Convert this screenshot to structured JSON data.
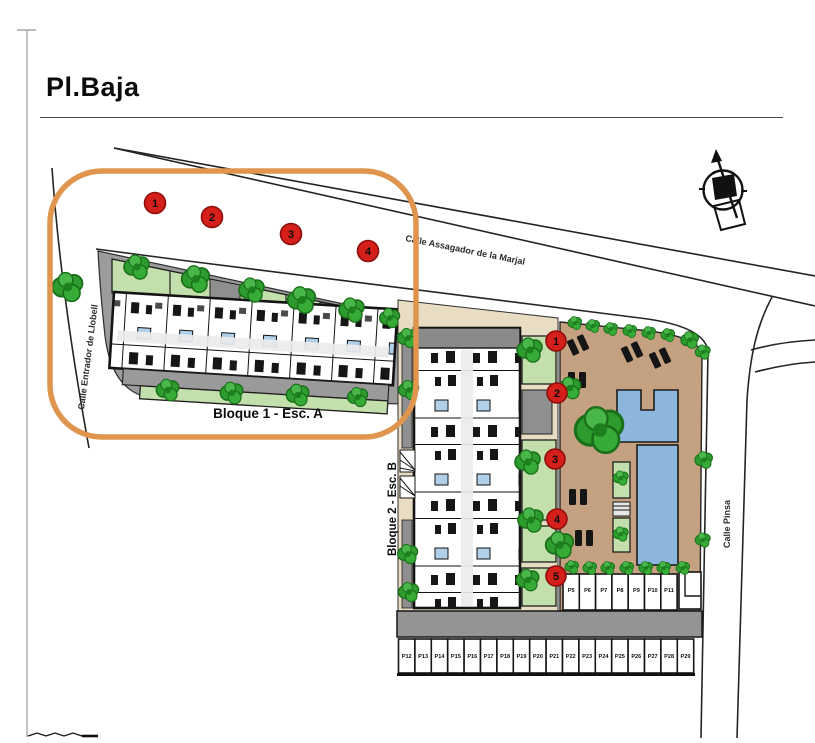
{
  "title": "Pl.Baja",
  "streets": {
    "top": "Calle Assagador de la Marjal",
    "left": "Calle Entrador de Llobell",
    "right": "Calle Pinsa"
  },
  "block1": {
    "label": "Bloque 1 - Esc. A",
    "markers": [
      "1",
      "2",
      "3",
      "4"
    ]
  },
  "block2": {
    "label": "Bloque 2 - Esc. B",
    "markers": [
      "1",
      "2",
      "3",
      "4",
      "5"
    ]
  },
  "parking": {
    "upper_row": [
      "P5",
      "P6",
      "P7",
      "P8",
      "P9",
      "P10",
      "P11"
    ],
    "lower_row": [
      "P12",
      "P13",
      "P14",
      "P15",
      "P16",
      "P17",
      "P18",
      "P19",
      "P20",
      "P21",
      "P22",
      "P23",
      "P24",
      "P25",
      "P26",
      "P27",
      "P28",
      "P29"
    ]
  },
  "legend": {
    "highlight_color": "#e0954e",
    "marker_color": "#d51f1a",
    "pool_color": "#8cb6dc",
    "garden_color": "#c3e0ac",
    "terrain_color": "#c4a181"
  },
  "icons": {
    "compass": "north-arrow"
  }
}
